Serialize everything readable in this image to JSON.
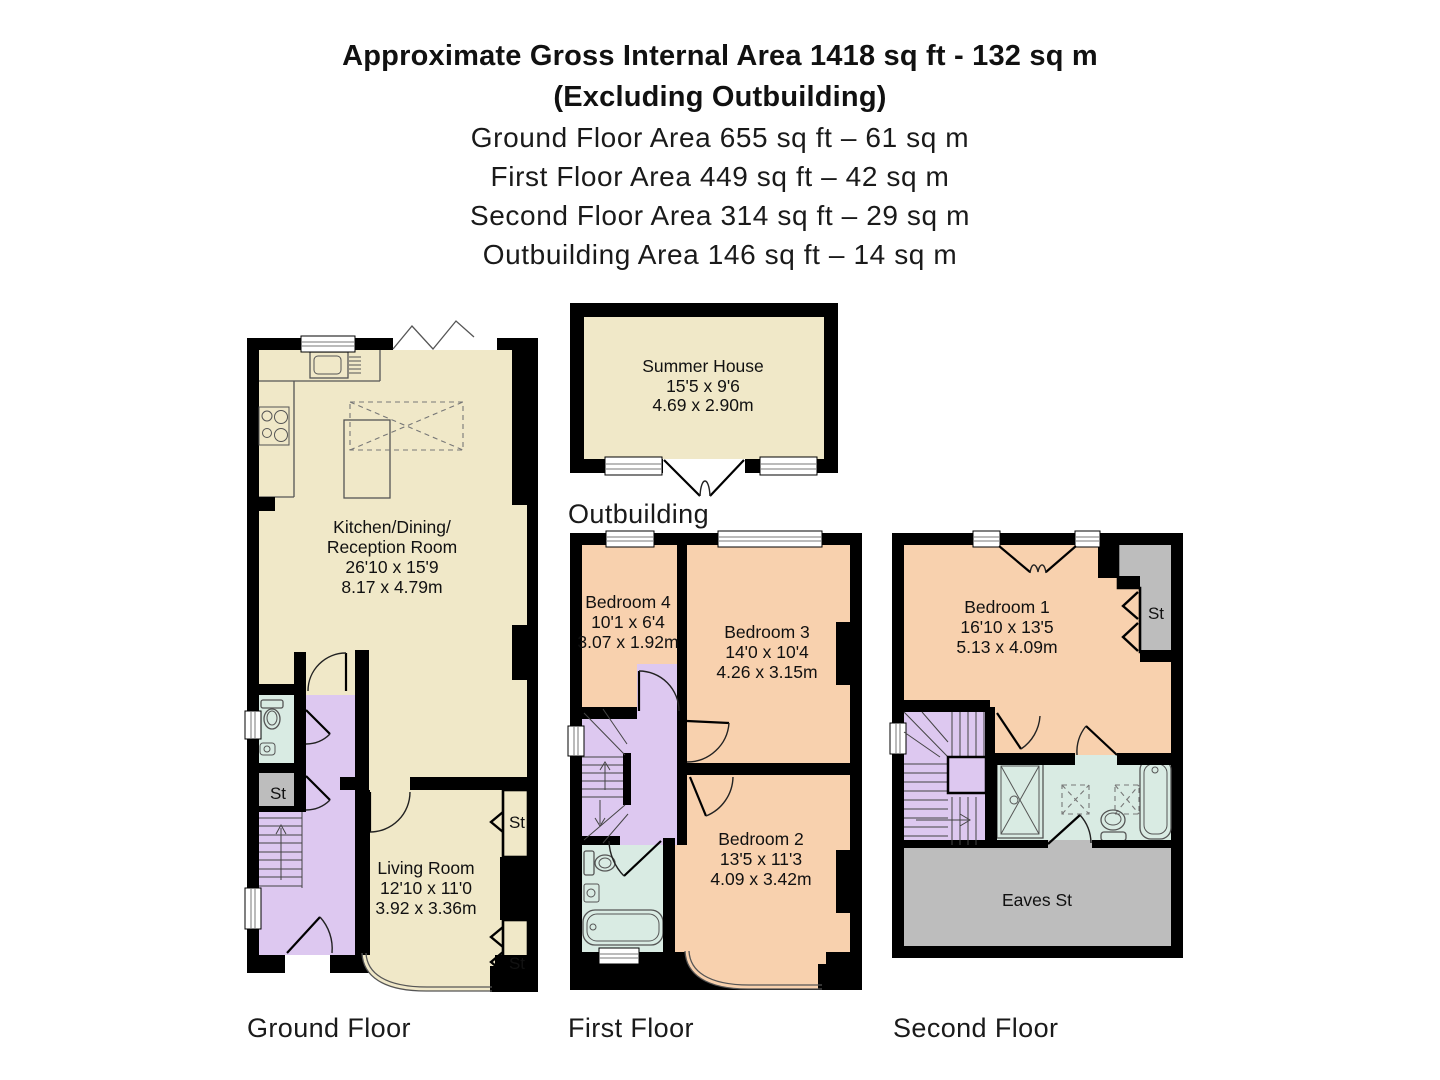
{
  "header": {
    "line1": "Approximate Gross Internal Area 1418 sq ft - 132 sq m",
    "line2": "(Excluding Outbuilding)",
    "sub": [
      "Ground Floor Area 655 sq ft – 61 sq m",
      "First Floor Area 449 sq ft – 42 sq m",
      "Second Floor Area 314 sq ft – 29 sq m",
      "Outbuilding Area 146 sq ft – 14 sq m"
    ]
  },
  "outbuilding": {
    "label": "Outbuilding",
    "room": {
      "name": "Summer House",
      "ft": "15'5 x 9'6",
      "m": "4.69 x 2.90m"
    }
  },
  "ground": {
    "label": "Ground Floor",
    "kitchen": {
      "l1": "Kitchen/Dining/",
      "l2": "Reception Room",
      "ft": "26'10 x 15'9",
      "m": "8.17 x 4.79m"
    },
    "living": {
      "name": "Living Room",
      "ft": "12'10 x 11'0",
      "m": "3.92 x 3.36m"
    },
    "st_left": "St",
    "st_right_top": "St",
    "st_right_bottom": "St"
  },
  "first": {
    "label": "First Floor",
    "bed4": {
      "name": "Bedroom 4",
      "ft": "10'1 x 6'4",
      "m": "3.07 x 1.92m"
    },
    "bed3": {
      "name": "Bedroom 3",
      "ft": "14'0 x 10'4",
      "m": "4.26 x 3.15m"
    },
    "bed2": {
      "name": "Bedroom 2",
      "ft": "13'5 x 11'3",
      "m": "4.09 x 3.42m"
    }
  },
  "second": {
    "label": "Second Floor",
    "bed1": {
      "name": "Bedroom 1",
      "ft": "16'10 x 13'5",
      "m": "5.13 x 4.09m"
    },
    "st": "St",
    "eaves": "Eaves St"
  },
  "colors": {
    "room_cream": "#f0e8c8",
    "room_peach": "#f8d1ae",
    "hall_lavender": "#ddc8f0",
    "bath_blue": "#d9ebe3",
    "storage_gray": "#bdbdbd",
    "wall_black": "#000000"
  }
}
